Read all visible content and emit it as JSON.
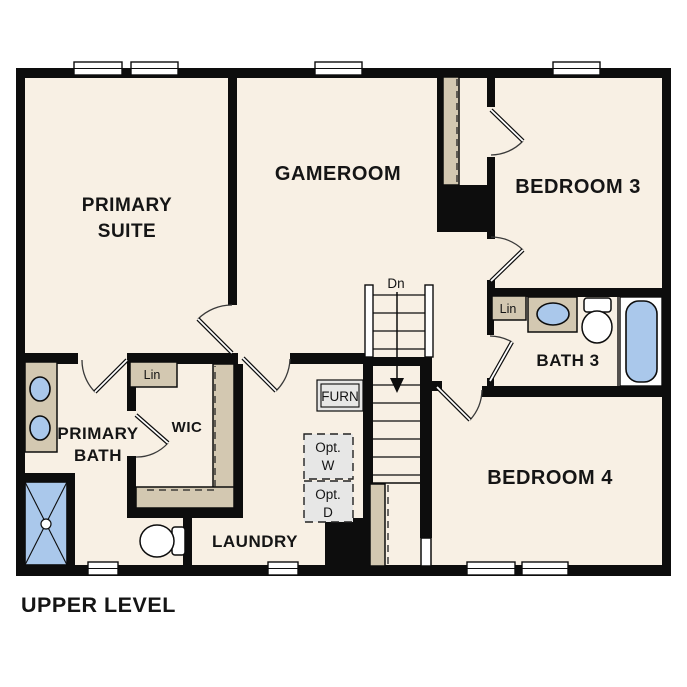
{
  "title": "UPPER LEVEL",
  "colors": {
    "wall": "#0d0d0d",
    "floor": "#f8f0e4",
    "cabinet": "#d3c8b1",
    "fixture": "#aac8eb",
    "optional": "#e7e7e6",
    "paper": "#ffffff",
    "text": "#151515"
  },
  "rooms": {
    "primary_suite": {
      "line1": "PRIMARY",
      "line2": "SUITE"
    },
    "gameroom": {
      "label": "GAMEROOM"
    },
    "bedroom3": {
      "label": "BEDROOM 3"
    },
    "bath3": {
      "label": "BATH 3"
    },
    "bedroom4": {
      "label": "BEDROOM 4"
    },
    "primary_bath": {
      "line1": "PRIMARY",
      "line2": "BATH"
    },
    "wic": {
      "label": "WIC"
    },
    "laundry": {
      "label": "LAUNDRY"
    }
  },
  "annotations": {
    "stair_direction": "Dn",
    "furnace": "FURN",
    "opt_washer": {
      "line1": "Opt.",
      "line2": "W"
    },
    "opt_dryer": {
      "line1": "Opt.",
      "line2": "D"
    },
    "linen_wic": "Lin",
    "linen_bath3": "Lin"
  }
}
